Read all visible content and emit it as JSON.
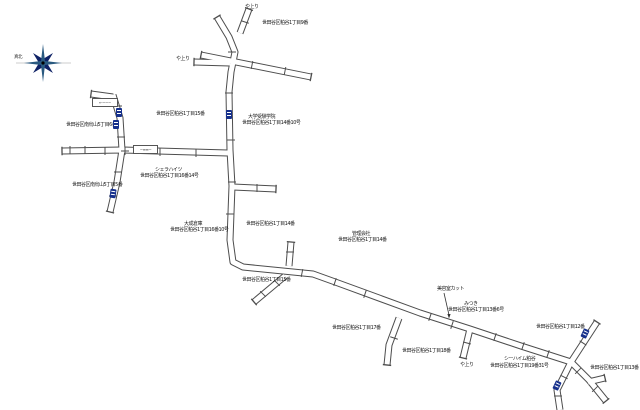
{
  "page": {
    "background": "#ffffff"
  },
  "colors": {
    "road": "#4d4d4d",
    "road_fill": "#ffffff",
    "plate": "#16308c",
    "compass_navy": "#0f2266",
    "compass_teal": "#2a5a80",
    "text": "#1a1a1a"
  },
  "compass": {
    "label": "真北"
  },
  "labels": [
    {
      "name": "slope-label-top",
      "text": "や上り",
      "x": 245,
      "y": 5
    },
    {
      "name": "block-label-9",
      "text": "世田谷区粕谷1丁目9番",
      "x": 262,
      "y": 21
    },
    {
      "name": "slope-label-west",
      "text": "や上り",
      "x": 176,
      "y": 57
    },
    {
      "name": "block-label-15-upper",
      "text": "世田谷区粕谷1丁目15番",
      "x": 156,
      "y": 112
    },
    {
      "name": "poi-label-school",
      "text": "大学受験学院",
      "x": 248,
      "y": 115
    },
    {
      "name": "address-label-14-10",
      "text": "世田谷区粕谷1丁目14番10号",
      "x": 242,
      "y": 121
    },
    {
      "name": "block-label-west-6",
      "text": "世田谷区南烏山5丁目6番",
      "x": 66,
      "y": 123
    },
    {
      "name": "poi-label-heights",
      "text": "シェラハイツ",
      "x": 155,
      "y": 168
    },
    {
      "name": "address-label-16-14",
      "text": "世田谷区粕谷1丁目16番14号",
      "x": 140,
      "y": 174
    },
    {
      "name": "block-label-west-5",
      "text": "世田谷区南烏山5丁目5番",
      "x": 72,
      "y": 183
    },
    {
      "name": "poi-label-warehouse",
      "text": "大成倉庫",
      "x": 184,
      "y": 222
    },
    {
      "name": "address-label-16-10",
      "text": "世田谷区粕谷1丁目16番10号",
      "x": 170,
      "y": 228
    },
    {
      "name": "block-label-14-left",
      "text": "世田谷区粕谷1丁目14番",
      "x": 246,
      "y": 222
    },
    {
      "name": "poi-label-office",
      "text": "管理会社",
      "x": 352,
      "y": 232
    },
    {
      "name": "block-label-14-right",
      "text": "世田谷区粕谷1丁目14番",
      "x": 338,
      "y": 238
    },
    {
      "name": "block-label-15-lower",
      "text": "世田谷区粕谷1丁目15番",
      "x": 242,
      "y": 278
    },
    {
      "name": "block-label-17",
      "text": "世田谷区粕谷1丁目17番",
      "x": 332,
      "y": 326
    },
    {
      "name": "poi-label-salon",
      "text": "美容室カット",
      "x": 437,
      "y": 287
    },
    {
      "name": "poi-label-mitsuki",
      "text": "みつき",
      "x": 464,
      "y": 302
    },
    {
      "name": "address-label-13-6",
      "text": "世田谷区粕谷1丁目13番6号",
      "x": 448,
      "y": 308
    },
    {
      "name": "block-label-12",
      "text": "世田谷区粕谷1丁目12番",
      "x": 536,
      "y": 325
    },
    {
      "name": "block-label-18",
      "text": "世田谷区粕谷1丁目18番",
      "x": 402,
      "y": 349
    },
    {
      "name": "slope-label-southeast",
      "text": "や上り",
      "x": 460,
      "y": 363
    },
    {
      "name": "poi-label-seaheim",
      "text": "シーハイム粕谷",
      "x": 504,
      "y": 357
    },
    {
      "name": "address-label-19-31",
      "text": "世田谷区粕谷1丁目19番31号",
      "x": 490,
      "y": 364
    },
    {
      "name": "block-label-13",
      "text": "世田谷区粕谷1丁目13番",
      "x": 590,
      "y": 366
    }
  ],
  "signboards": [
    {
      "name": "signboard-west-upper",
      "text": "←−−−",
      "x": 92,
      "y": 98,
      "w": 26,
      "h": 9
    },
    {
      "name": "signboard-crossroads",
      "text": "−≡≡−",
      "x": 133,
      "y": 145,
      "w": 25,
      "h": 9
    }
  ],
  "plates": [
    {
      "x": 116,
      "y": 108,
      "rot": 0
    },
    {
      "x": 113,
      "y": 120,
      "rot": 0
    },
    {
      "x": 110,
      "y": 189,
      "rot": 8
    },
    {
      "x": 226,
      "y": 110,
      "rot": 0
    },
    {
      "x": 582,
      "y": 329,
      "rot": 25
    },
    {
      "x": 554,
      "y": 381,
      "rot": 25
    }
  ]
}
